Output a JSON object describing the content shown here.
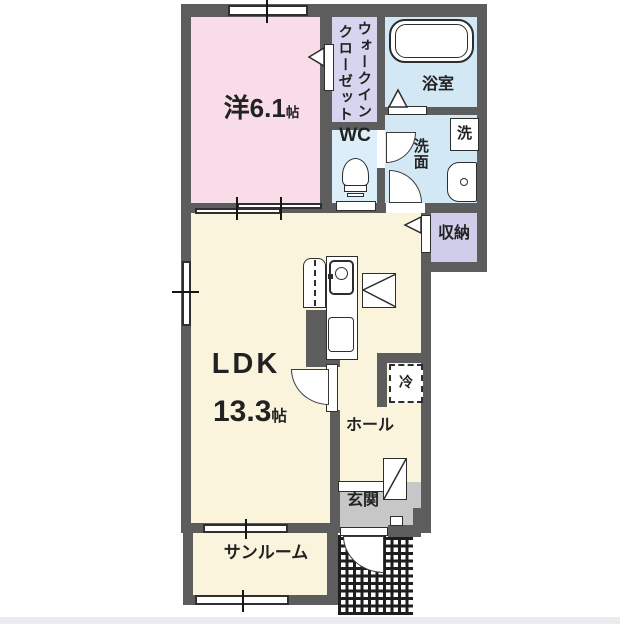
{
  "floorplan": {
    "type": "japanese-apartment-floor-plan",
    "rooms": {
      "bedroom": {
        "label_main": "洋6.1",
        "label_unit": "帖",
        "color": "#f8dce8"
      },
      "walk_in_closet": {
        "label": "ウォークインクローゼット",
        "label_line1": "ウォークイン",
        "label_line2": "クローゼット",
        "color": "#d6d4ee"
      },
      "bathroom": {
        "label": "浴室",
        "color": "#d2e8f5"
      },
      "toilet_room": {
        "label": "WC",
        "color": "#dceefa"
      },
      "washroom": {
        "label": "洗面",
        "color": "#d2e8f5"
      },
      "storage": {
        "label": "収納",
        "color": "#d0cdea"
      },
      "ldk": {
        "label_main": "LDK",
        "label_size": "13.3",
        "label_unit": "帖",
        "color": "#fbf4dd"
      },
      "hall": {
        "label": "ホール",
        "color": "#fbf4dd"
      },
      "entrance": {
        "label": "玄関",
        "color": "#c7c7c7"
      },
      "sunroom": {
        "label": "サンルーム",
        "color": "#fbf4dd"
      }
    },
    "fixtures": {
      "washing_machine": {
        "label": "洗"
      },
      "refrigerator": {
        "label": "冷"
      }
    },
    "colors": {
      "wall": "#5d5d5d",
      "opening": "#ffffff",
      "line": "#2d2d2d",
      "porch_tile": "#1e1e1e",
      "outside": "#ffffff"
    }
  }
}
